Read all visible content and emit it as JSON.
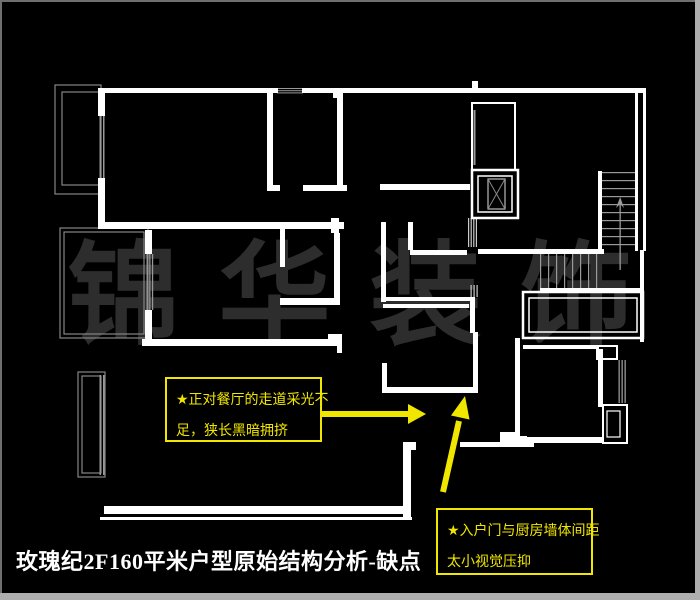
{
  "title": {
    "text": "玫瑰纪2F160平米户型原始结构分析-缺点",
    "color": "#ffffff"
  },
  "watermark": {
    "text": "锦 华 装 饰",
    "color": "#2d2d2d"
  },
  "annotations": [
    {
      "lines": [
        "★正对餐厅的走道采光不",
        "足，狭长黑暗拥挤"
      ],
      "color": "#f0e600"
    },
    {
      "lines": [
        "★入户门与厨房墙体间距",
        "太小视觉压抑"
      ],
      "color": "#f0e600"
    }
  ],
  "colors": {
    "background": "#000000",
    "wall": "#ffffff",
    "secondary_gray": "#9a9a9a",
    "balcony_gray": "#858585",
    "annotation_yellow": "#f0e600",
    "frame_gray": "#aeaeae"
  }
}
